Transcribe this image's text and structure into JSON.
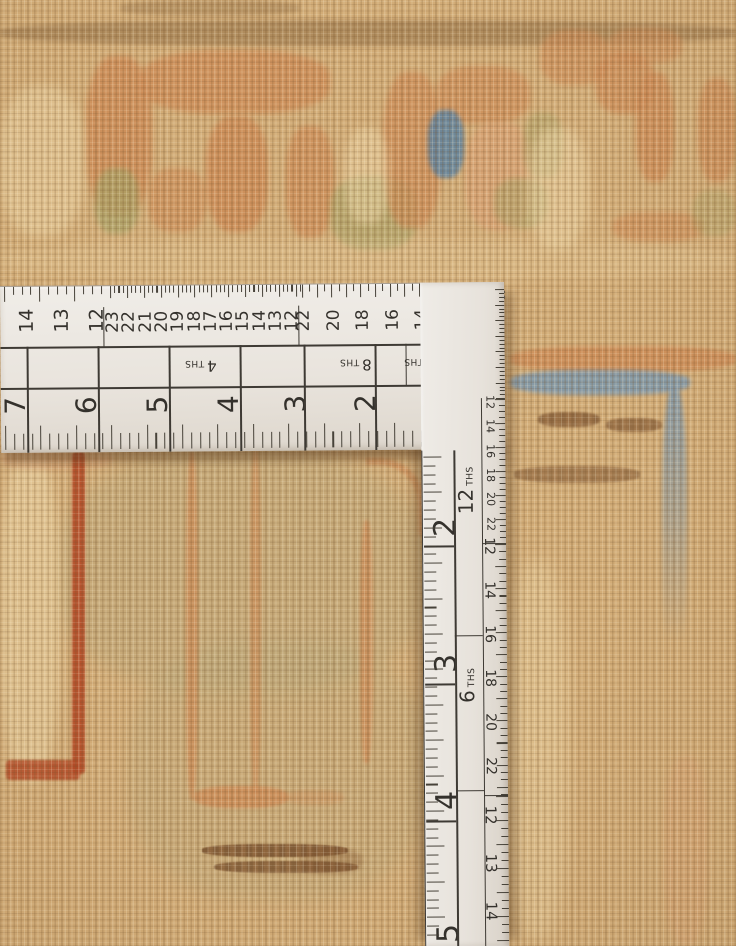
{
  "ruler": {
    "colors": {
      "body": "#ebe7e0",
      "markings": "#3a3631"
    },
    "horizontal_arm": {
      "top_scale_a": [
        "14",
        "13",
        "12"
      ],
      "top_scale_b": [
        "23",
        "22",
        "21",
        "20",
        "19",
        "18",
        "17",
        "16",
        "15",
        "14",
        "13",
        "12"
      ],
      "top_scale_c": [
        "22",
        "20",
        "18",
        "16",
        "14",
        "12"
      ],
      "corner_tiny_row_1": [
        "22",
        "20",
        "18",
        "16",
        "14",
        "12"
      ],
      "corner_tiny_row_2": [
        "20",
        "16",
        "12"
      ],
      "graduation_boxes": [
        {
          "value": "4",
          "unit": "THS"
        },
        {
          "value": "8",
          "unit": "THS"
        },
        {
          "value": "16",
          "unit": "THS"
        },
        {
          "value": "32",
          "unit": ""
        }
      ],
      "inch_numbers": [
        "7",
        "6",
        "5",
        "4",
        "3",
        "2"
      ]
    },
    "corner": {
      "number": "24",
      "micro_scale": [
        "12",
        "16",
        "20"
      ]
    },
    "vertical_arm": {
      "inch_numbers": [
        "2",
        "3",
        "4",
        "5"
      ],
      "graduation_labels": [
        {
          "value": "12",
          "unit": "THS"
        },
        {
          "value": "6",
          "unit": "THS"
        }
      ],
      "edge_scale_1": [
        "12",
        "14",
        "16",
        "18",
        "20",
        "22"
      ],
      "edge_scale_2": [
        "12",
        "14",
        "16",
        "18",
        "20",
        "22"
      ],
      "edge_scale_3": [
        "12",
        "13",
        "14"
      ]
    }
  },
  "rug": {
    "colors": {
      "base": "#d2ac77",
      "salmon": "#cd8a55",
      "salmon_light": "#d9a072",
      "green": "#a8a266",
      "blue_accent": "#5d82a0",
      "blue_band": "#7b97ae",
      "red": "#b44a26",
      "brown": "#7d4f2b",
      "dark_brown": "#6b4a28",
      "cream": "#ecd5a5",
      "olive": "#b2a57a"
    }
  }
}
